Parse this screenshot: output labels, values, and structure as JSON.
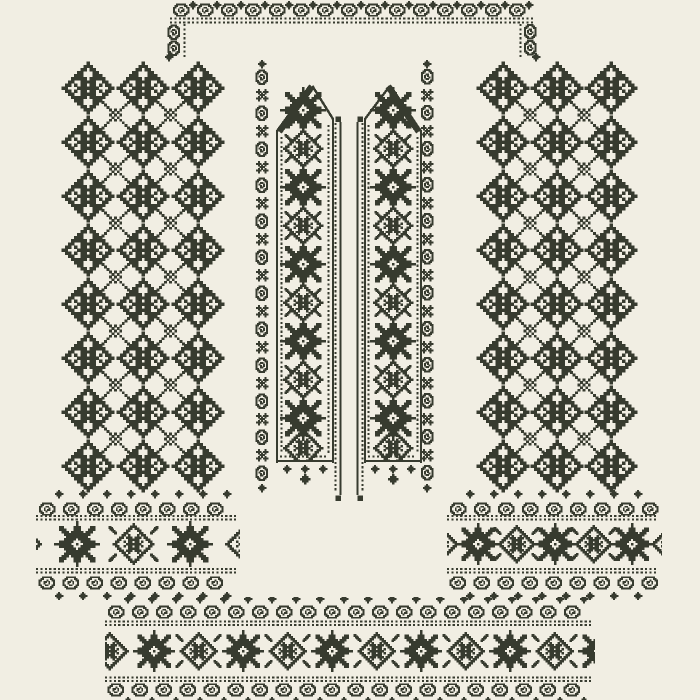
{
  "artwork": {
    "description": "cross-stitch embroidery pattern sheet for a traditional shirt: neckline band with corner brackets, two vertical placket bands, diamond lattice side panels, two cuff borders, hem border"
  },
  "colors": {
    "ink": "#373b2f",
    "bg": "#f1eee3"
  },
  "motifs": {
    "rosette": [
      "........#........",
      ".......###.......",
      "......##.##......",
      ".....##...##.....",
      "....###...###....",
      "...#####.#####...",
      "..##..#####..##..",
      ".##.#.##.##.#.##.",
      "##...#######...##",
      ".##.#.##.##.#.##.",
      "..##..#####..##..",
      "...#####.#####...",
      "....###...###....",
      ".....##...##.....",
      "......##.##......",
      ".......###.......",
      "........#........"
    ],
    "xlink": [
      "#.........#",
      ".#.......#.",
      "..#.....#..",
      "...#.#.#...",
      "....#.#....",
      "...#.#.#...",
      "....#.#....",
      "...#.#.#...",
      "..#.....#..",
      ".#.......#.",
      "#.........#"
    ],
    "star8": [
      ".........#.........",
      ".........#.........",
      "..##....###....##..",
      "..###...###...###..",
      "...###.#####.###...",
      "....###########....",
      ".....#########.....",
      "....#####.#####....",
      "..######...######..",
      "#######..#..#######",
      "..######...######..",
      "....#####.#####....",
      ".....#########.....",
      "....###########....",
      "...###.#####.###...",
      "..###...###...###..",
      "..##....###....##..",
      ".........#.........",
      ".........#........."
    ],
    "medallion": [
      ".........#.........",
      "........###........",
      ".......##.##.......",
      "......##...##......",
      ".....##.....##.....",
      "....##.#...#.##....",
      "...##.###.###.##...",
      "..##...#####...##..",
      ".##..#.##.##.#..##.",
      "##....#######....##",
      ".##..#.##.##.#..##.",
      "..##...#####...##..",
      "...##.###.###.##...",
      "....##.#...#.##....",
      ".....##.....##.....",
      "......##...##......",
      ".......##.##.......",
      "........###........",
      ".........#........."
    ],
    "curl": [
      "..######..",
      ".##....##.",
      "##..##..##",
      "#..#..#..#",
      "#..#.##..#",
      "##..#...##",
      ".##....##.",
      "..######.."
    ],
    "dia5": [
      "..#..",
      ".###.",
      "#####",
      ".###.",
      "..#.."
    ],
    "floret": [
      ".#...#.",
      "###.###",
      ".#.#.#.",
      "..###..",
      ".#.#.#.",
      "###.###",
      ".#...#."
    ],
    "hook": [
      "##....",
      "###...",
      ".###..",
      "..###.",
      "...###",
      "....##"
    ],
    "cap": [
      "###",
      "###",
      "###"
    ]
  },
  "clips": {
    "bandL": [
      276,
      85,
      58,
      375
    ],
    "bandR": [
      364,
      85,
      58,
      375
    ],
    "cuffL": [
      36,
      486,
      204,
      114
    ],
    "cuffR": [
      447,
      486,
      215,
      114
    ],
    "bottom": [
      105,
      597,
      490,
      103
    ]
  },
  "elements": [
    {
      "name": "neckline-scroll-strip",
      "kind": "scrollrow",
      "x1": 172,
      "x2": 534,
      "y": 10,
      "dy": -5,
      "flip": false
    },
    {
      "name": "neckline-dotline-a",
      "kind": "dots_h",
      "x1": 170,
      "x2": 535,
      "y": 18.5
    },
    {
      "name": "neckline-dotline-b",
      "kind": "dots_h",
      "x1": 170,
      "x2": 535,
      "y": 22.5
    },
    {
      "name": "neck-bracket-left-dots",
      "kind": "dots_v",
      "x": 184.5,
      "y1": 24,
      "y2": 60
    },
    {
      "name": "neck-bracket-left-curls",
      "kind": "stamps",
      "motif": "curl",
      "cell": 1.5,
      "rot": 90,
      "pts": [
        [
          174,
          32
        ],
        [
          174,
          48
        ]
      ]
    },
    {
      "name": "neck-bracket-left-finial",
      "kind": "stamps",
      "motif": "dia5",
      "cell": 1.6,
      "pts": [
        [
          169,
          57
        ]
      ]
    },
    {
      "name": "neck-bracket-right-dots",
      "kind": "dots_v",
      "x": 520.5,
      "y1": 24,
      "y2": 60
    },
    {
      "name": "neck-bracket-right-curls",
      "kind": "stamps",
      "motif": "curl",
      "cell": 1.5,
      "rot": -90,
      "pts": [
        [
          530,
          32
        ],
        [
          530,
          48
        ]
      ]
    },
    {
      "name": "neck-bracket-right-finial",
      "kind": "stamps",
      "motif": "dia5",
      "cell": 1.6,
      "pts": [
        [
          536,
          57
        ]
      ]
    },
    {
      "name": "left-lattice-rosettes",
      "kind": "grid",
      "motif": "rosette",
      "cell": 3.1,
      "xs": [
        88,
        143,
        198
      ],
      "ys": [
        88,
        142,
        196,
        250,
        304,
        358,
        412,
        466
      ]
    },
    {
      "name": "left-lattice-links",
      "kind": "grid",
      "motif": "xlink",
      "cell": 2.55,
      "xs": [
        115.5,
        170.5
      ],
      "ys": [
        115,
        169,
        223,
        277,
        331,
        385,
        439
      ]
    },
    {
      "name": "right-lattice-rosettes",
      "kind": "grid",
      "motif": "rosette",
      "cell": 3.1,
      "xs": [
        503,
        557,
        611
      ],
      "ys": [
        88,
        142,
        196,
        250,
        304,
        358,
        412,
        466
      ]
    },
    {
      "name": "right-lattice-links",
      "kind": "grid",
      "motif": "xlink",
      "cell": 2.55,
      "xs": [
        530,
        584
      ],
      "ys": [
        115,
        169,
        223,
        277,
        331,
        385,
        439
      ]
    },
    {
      "name": "left-band-outer-scroll",
      "kind": "scrollcol",
      "x": 262,
      "y1": 70,
      "y2": 482,
      "rot": 90
    },
    {
      "name": "left-band-outer-finials",
      "kind": "stamps",
      "motif": "dia5",
      "cell": 1.6,
      "pts": [
        [
          262,
          64
        ],
        [
          262,
          488
        ]
      ]
    },
    {
      "name": "left-band-outline",
      "kind": "polyline",
      "w": 2.4,
      "pts": [
        [
          277,
          462
        ],
        [
          277,
          131
        ],
        [
          313,
          87
        ],
        [
          333,
          119
        ],
        [
          333,
          462
        ]
      ]
    },
    {
      "name": "left-band-shoulder-slope",
      "kind": "polyline",
      "w": 6.5,
      "pts": [
        [
          281,
          129
        ],
        [
          310,
          89
        ]
      ]
    },
    {
      "name": "left-band-edge-dots-a",
      "kind": "dots_v",
      "x": 281.5,
      "y1": 137,
      "y2": 454
    },
    {
      "name": "left-band-edge-dots-b",
      "kind": "dots_v",
      "x": 328.5,
      "y1": 125,
      "y2": 454
    },
    {
      "name": "left-band-stars",
      "kind": "stamps",
      "motif": "star8",
      "cell": 2.4,
      "clip": "bandL",
      "pts": [
        [
          303,
          110
        ],
        [
          303,
          187
        ],
        [
          303,
          264
        ],
        [
          303,
          341
        ],
        [
          303,
          418
        ]
      ]
    },
    {
      "name": "left-band-medallions",
      "kind": "stamps",
      "motif": "medallion",
      "cell": 2.1,
      "clip": "bandL",
      "pts": [
        [
          303,
          148.5
        ],
        [
          303,
          225.5
        ],
        [
          303,
          302.5
        ],
        [
          303,
          379.5
        ],
        [
          303,
          448
        ]
      ]
    },
    {
      "name": "left-band-corner-hooks",
      "kind": "hookset",
      "cell": 1.2,
      "dx": 15,
      "dy": 11,
      "pts": [
        [
          303,
          148.5
        ],
        [
          303,
          225.5
        ],
        [
          303,
          302.5
        ],
        [
          303,
          379.5
        ]
      ]
    },
    {
      "name": "left-band-bottom-line",
      "kind": "line",
      "x1": 277,
      "y1": 461,
      "x2": 333,
      "y2": 461,
      "w": 2.4
    },
    {
      "name": "left-band-bottom-dots",
      "kind": "dots_h",
      "x1": 280,
      "x2": 330,
      "y": 456.5
    },
    {
      "name": "left-band-scallop",
      "kind": "stamps",
      "motif": "dia5",
      "cell": 1.6,
      "pts": [
        [
          287,
          469
        ],
        [
          305,
          469
        ],
        [
          323,
          469
        ]
      ]
    },
    {
      "name": "left-band-point",
      "kind": "stamps",
      "motif": "dia5",
      "cell": 2.0,
      "pts": [
        [
          305,
          479
        ]
      ]
    },
    {
      "name": "right-band-outer-scroll",
      "kind": "scrollcol",
      "x": 427,
      "y1": 70,
      "y2": 482,
      "rot": -90
    },
    {
      "name": "right-band-outer-finials",
      "kind": "stamps",
      "motif": "dia5",
      "cell": 1.6,
      "pts": [
        [
          427,
          64
        ],
        [
          427,
          488
        ]
      ]
    },
    {
      "name": "right-band-outline",
      "kind": "polyline",
      "w": 2.4,
      "pts": [
        [
          421,
          462
        ],
        [
          421,
          131
        ],
        [
          389,
          87
        ],
        [
          365,
          119
        ],
        [
          365,
          462
        ]
      ]
    },
    {
      "name": "right-band-shoulder-slope",
      "kind": "polyline",
      "w": 6.5,
      "pts": [
        [
          417,
          129
        ],
        [
          390,
          89
        ]
      ]
    },
    {
      "name": "right-band-edge-dots-a",
      "kind": "dots_v",
      "x": 417.5,
      "y1": 137,
      "y2": 454
    },
    {
      "name": "right-band-edge-dots-b",
      "kind": "dots_v",
      "x": 368.5,
      "y1": 125,
      "y2": 454
    },
    {
      "name": "right-band-stars",
      "kind": "stamps",
      "motif": "star8",
      "cell": 2.4,
      "clip": "bandR",
      "pts": [
        [
          393,
          110
        ],
        [
          393,
          187
        ],
        [
          393,
          264
        ],
        [
          393,
          341
        ],
        [
          393,
          418
        ]
      ]
    },
    {
      "name": "right-band-medallions",
      "kind": "stamps",
      "motif": "medallion",
      "cell": 2.1,
      "clip": "bandR",
      "pts": [
        [
          393,
          148.5
        ],
        [
          393,
          225.5
        ],
        [
          393,
          302.5
        ],
        [
          393,
          379.5
        ],
        [
          393,
          448
        ]
      ]
    },
    {
      "name": "right-band-corner-hooks",
      "kind": "hookset",
      "cell": 1.2,
      "dx": 15,
      "dy": 11,
      "pts": [
        [
          393,
          148.5
        ],
        [
          393,
          225.5
        ],
        [
          393,
          302.5
        ],
        [
          393,
          379.5
        ]
      ]
    },
    {
      "name": "right-band-bottom-line",
      "kind": "line",
      "x1": 365,
      "y1": 461,
      "x2": 421,
      "y2": 461,
      "w": 2.4
    },
    {
      "name": "right-band-bottom-dots",
      "kind": "dots_h",
      "x1": 368,
      "x2": 418,
      "y": 456.5
    },
    {
      "name": "right-band-scallop",
      "kind": "stamps",
      "motif": "dia5",
      "cell": 1.6,
      "pts": [
        [
          375,
          469
        ],
        [
          393,
          469
        ],
        [
          411,
          469
        ]
      ]
    },
    {
      "name": "right-band-point",
      "kind": "stamps",
      "motif": "dia5",
      "cell": 2.0,
      "pts": [
        [
          393,
          479
        ]
      ]
    },
    {
      "name": "placket-left-line",
      "kind": "line",
      "x1": 340.5,
      "y1": 122,
      "x2": 340.5,
      "y2": 495,
      "w": 2.2
    },
    {
      "name": "placket-left-dots",
      "kind": "dots_v",
      "x": 335.5,
      "y1": 123,
      "y2": 493
    },
    {
      "name": "placket-left-caps",
      "kind": "stamps",
      "motif": "cap",
      "cell": 1.8,
      "pts": [
        [
          338,
          119
        ],
        [
          338,
          498
        ]
      ]
    },
    {
      "name": "placket-right-line",
      "kind": "line",
      "x1": 357.5,
      "y1": 122,
      "x2": 357.5,
      "y2": 495,
      "w": 2.2
    },
    {
      "name": "placket-right-dots",
      "kind": "dots_v",
      "x": 362.5,
      "y1": 123,
      "y2": 493
    },
    {
      "name": "placket-right-caps",
      "kind": "stamps",
      "motif": "cap",
      "cell": 1.8,
      "pts": [
        [
          360,
          119
        ],
        [
          360,
          498
        ]
      ]
    },
    {
      "name": "left-cuff-top-scroll",
      "kind": "scrollrow",
      "x1": 38,
      "x2": 238,
      "y": 509,
      "dy": -15,
      "flip": false,
      "clip": "cuffL"
    },
    {
      "name": "left-cuff-top-dots-a",
      "kind": "dots_h",
      "x1": 36,
      "x2": 240,
      "y": 516
    },
    {
      "name": "left-cuff-top-dots-b",
      "kind": "dots_h",
      "x1": 36,
      "x2": 240,
      "y": 519.5
    },
    {
      "name": "left-cuff-stars",
      "kind": "stamps",
      "motif": "star8",
      "cell": 2.4,
      "clip": "cuffL",
      "pts": [
        [
          77,
          544
        ],
        [
          190,
          544
        ]
      ]
    },
    {
      "name": "left-cuff-medallions",
      "kind": "stamps",
      "motif": "medallion",
      "cell": 2.2,
      "clip": "cuffL",
      "pts": [
        [
          21,
          544
        ],
        [
          133.5,
          544
        ],
        [
          246,
          544
        ]
      ]
    },
    {
      "name": "left-cuff-corner-hooks",
      "kind": "hookset",
      "cell": 1.4,
      "dx": 21,
      "dy": 14,
      "pts": [
        [
          133.5,
          544
        ]
      ]
    },
    {
      "name": "left-cuff-bottom-dots-a",
      "kind": "dots_h",
      "x1": 36,
      "x2": 240,
      "y": 569
    },
    {
      "name": "left-cuff-bottom-dots-b",
      "kind": "dots_h",
      "x1": 36,
      "x2": 240,
      "y": 572.5
    },
    {
      "name": "left-cuff-bottom-scroll",
      "kind": "scrollrow",
      "x1": 38,
      "x2": 238,
      "y": 583,
      "dy": 13,
      "flip": true,
      "clip": "cuffL"
    },
    {
      "name": "right-cuff-top-scroll",
      "kind": "scrollrow",
      "x1": 449,
      "x2": 658,
      "y": 509,
      "dy": -15,
      "flip": false,
      "clip": "cuffR"
    },
    {
      "name": "right-cuff-top-dots-a",
      "kind": "dots_h",
      "x1": 447,
      "x2": 660,
      "y": 516
    },
    {
      "name": "right-cuff-top-dots-b",
      "kind": "dots_h",
      "x1": 447,
      "x2": 660,
      "y": 519.5
    },
    {
      "name": "right-cuff-stars",
      "kind": "stamps",
      "motif": "star8",
      "cell": 2.2,
      "clip": "cuffR",
      "pts": [
        [
          478,
          544
        ],
        [
          555,
          544
        ],
        [
          632,
          544
        ]
      ]
    },
    {
      "name": "right-cuff-medallions",
      "kind": "stamps",
      "motif": "medallion",
      "cell": 2.0,
      "clip": "cuffR",
      "pts": [
        [
          439.5,
          544
        ],
        [
          516.5,
          544
        ],
        [
          593.5,
          544
        ],
        [
          670,
          544
        ]
      ]
    },
    {
      "name": "right-cuff-corner-hooks",
      "kind": "hookset",
      "cell": 1.3,
      "dx": 19,
      "dy": 13,
      "pts": [
        [
          516.5,
          544
        ],
        [
          593.5,
          544
        ]
      ]
    },
    {
      "name": "right-cuff-bottom-dots-a",
      "kind": "dots_h",
      "x1": 447,
      "x2": 660,
      "y": 569
    },
    {
      "name": "right-cuff-bottom-dots-b",
      "kind": "dots_h",
      "x1": 447,
      "x2": 660,
      "y": 572.5
    },
    {
      "name": "right-cuff-bottom-scroll",
      "kind": "scrollrow",
      "x1": 449,
      "x2": 658,
      "y": 583,
      "dy": 13,
      "flip": true,
      "clip": "cuffR"
    },
    {
      "name": "hem-top-scroll",
      "kind": "scrollrow",
      "x1": 107,
      "x2": 593,
      "y": 612,
      "dy": -13,
      "flip": false,
      "clip": "bottom"
    },
    {
      "name": "hem-top-dots-a",
      "kind": "dots_h",
      "x1": 105,
      "x2": 595,
      "y": 621.5
    },
    {
      "name": "hem-top-dots-b",
      "kind": "dots_h",
      "x1": 105,
      "x2": 595,
      "y": 625
    },
    {
      "name": "hem-stars",
      "kind": "stamps",
      "motif": "star8",
      "cell": 2.2,
      "clip": "bottom",
      "pts": [
        [
          154,
          651
        ],
        [
          243,
          651
        ],
        [
          332,
          651
        ],
        [
          421,
          651
        ],
        [
          510,
          651
        ],
        [
          599,
          651
        ]
      ]
    },
    {
      "name": "hem-medallions",
      "kind": "stamps",
      "motif": "medallion",
      "cell": 2.0,
      "clip": "bottom",
      "pts": [
        [
          109.5,
          651
        ],
        [
          198.5,
          651
        ],
        [
          287.5,
          651
        ],
        [
          376.5,
          651
        ],
        [
          465.5,
          651
        ],
        [
          554.5,
          651
        ]
      ]
    },
    {
      "name": "hem-corner-hooks",
      "kind": "hookset",
      "cell": 1.3,
      "dx": 19,
      "dy": 13,
      "pts": [
        [
          198.5,
          651
        ],
        [
          287.5,
          651
        ],
        [
          376.5,
          651
        ],
        [
          465.5,
          651
        ],
        [
          554.5,
          651
        ]
      ]
    },
    {
      "name": "hem-bottom-dots-a",
      "kind": "dots_h",
      "x1": 105,
      "x2": 595,
      "y": 677.5
    },
    {
      "name": "hem-bottom-dots-b",
      "kind": "dots_h",
      "x1": 105,
      "x2": 595,
      "y": 681
    },
    {
      "name": "hem-bottom-scroll",
      "kind": "scrollrow",
      "x1": 107,
      "x2": 593,
      "y": 690,
      "dy": 11,
      "flip": true,
      "clip": "bottom"
    }
  ]
}
